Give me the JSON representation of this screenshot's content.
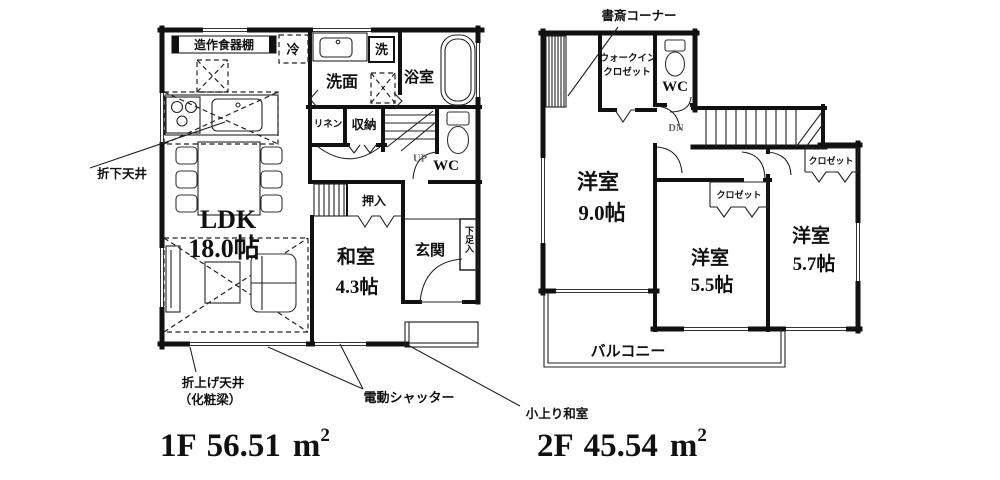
{
  "floor1": {
    "labels": {
      "cupboard": "造作食器棚",
      "fridge": "冷",
      "washroom": "洗面",
      "washer": "洗",
      "bathroom": "浴室",
      "linen": "リネン",
      "storage": "収納",
      "up": "UP",
      "wc": "WC",
      "oshiire": "押入",
      "washitsu": "和室",
      "washitsu_size": "4.3帖",
      "genkan": "玄関",
      "shoebox": "下足入",
      "ldk": "LDK",
      "ldk_size": "18.0帖"
    },
    "annotations": {
      "lowered_ceiling": "折下天井",
      "raised_ceiling1": "折上げ天井",
      "raised_ceiling2": "（化粧梁）",
      "shutter": "電動シャッター",
      "raised_tatami": "小上り和室"
    },
    "area": {
      "floor": "1F",
      "value": "56.51",
      "unit": "m",
      "sup": "2"
    }
  },
  "floor2": {
    "labels": {
      "study": "書斎コーナー",
      "wic1": "ウォークイン",
      "wic2": "クロゼット",
      "wc": "WC",
      "dn": "DN",
      "room9": "洋室",
      "room9_size": "9.0帖",
      "room55": "洋室",
      "room55_size": "5.5帖",
      "room57": "洋室",
      "room57_size": "5.7帖",
      "closet55": "クロゼット",
      "closet57": "クロゼット",
      "balcony": "バルコニー"
    },
    "area": {
      "floor": "2F",
      "value": "45.54",
      "unit": "m",
      "sup": "2"
    }
  }
}
